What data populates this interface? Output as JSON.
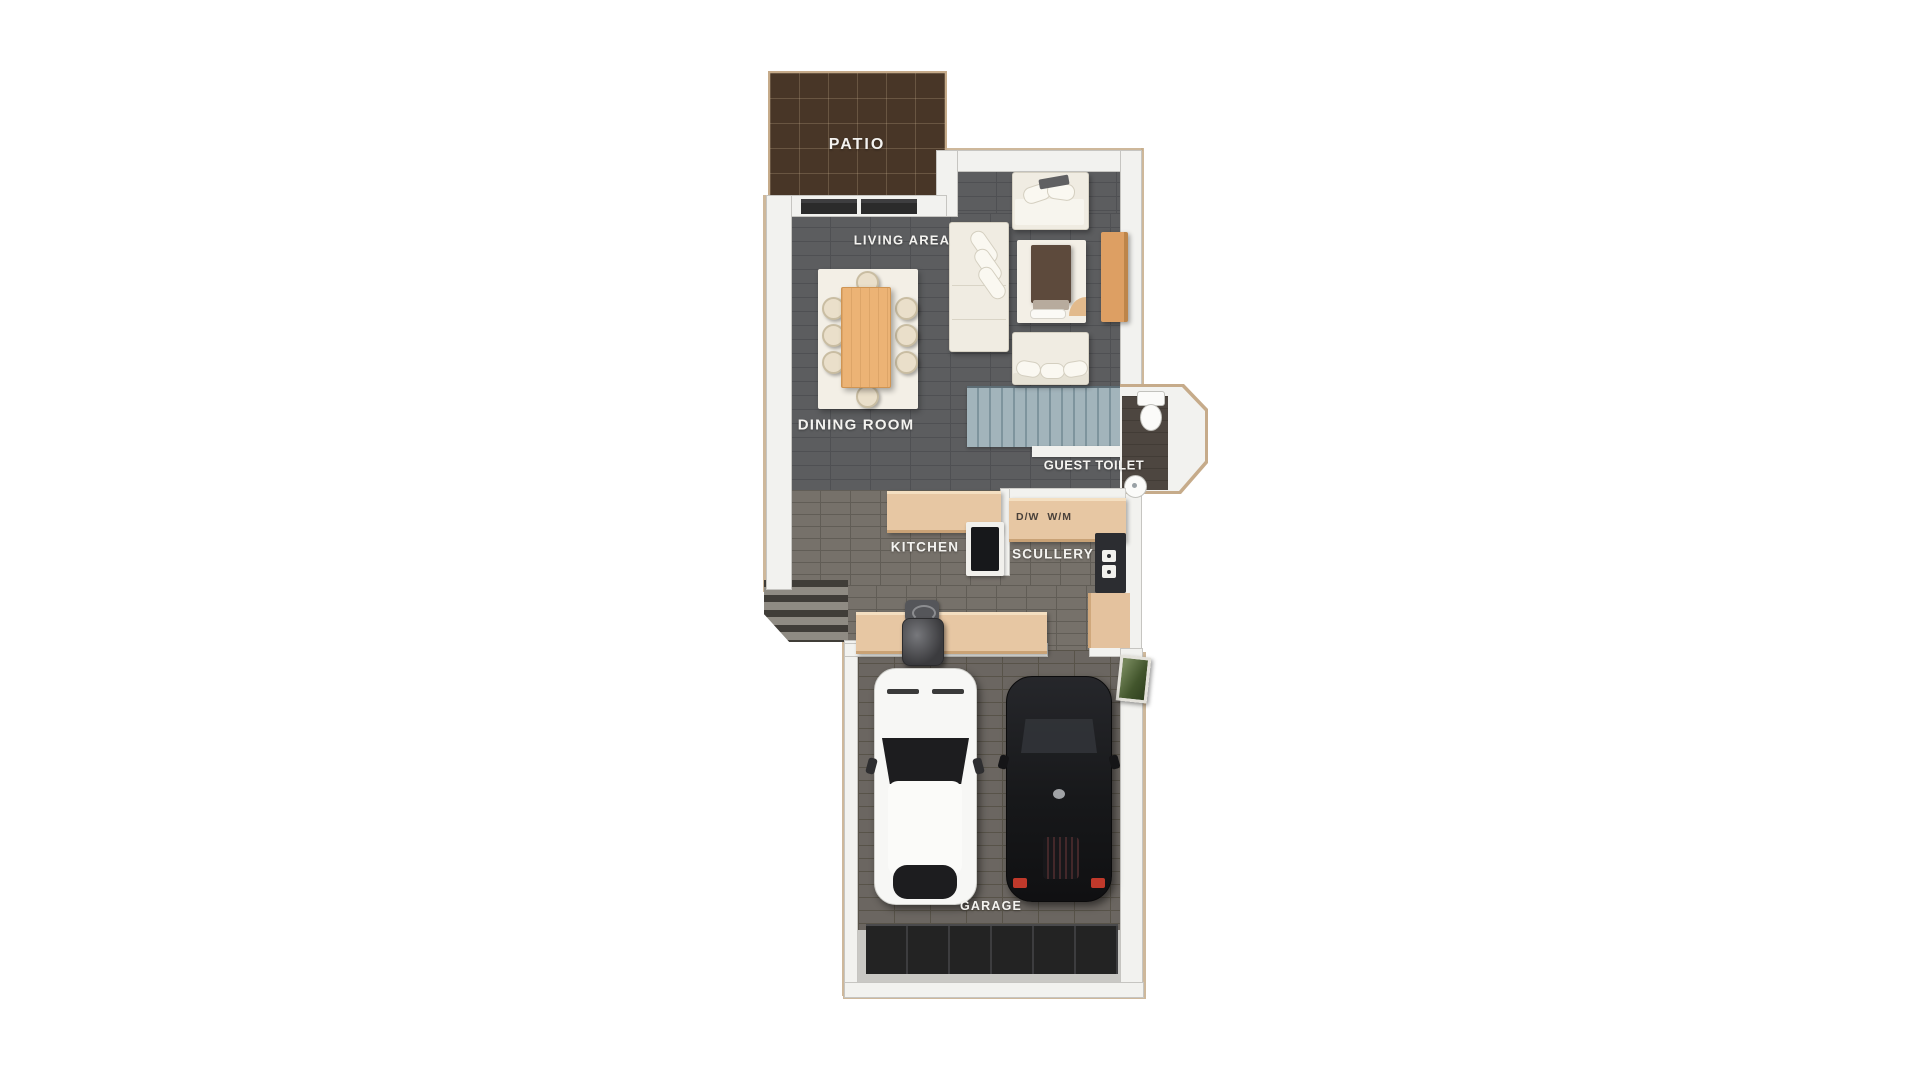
{
  "plan": {
    "type": "floor-plan",
    "labels": {
      "patio": "PATIO",
      "living_area": "LIVING AREA",
      "dining_room": "DINING ROOM",
      "guest_toilet": "GUEST TOILET",
      "kitchen": "KITCHEN",
      "scullery": "SCULLERY",
      "appliances": "D/W W/M",
      "garage": "GARAGE"
    },
    "colors": {
      "background": "#ffffff",
      "wall": "#f2f2ef",
      "outer_line": "#c6ab8a",
      "floor_dark": "#5c5d5f",
      "floor_kitchen": "#76716a",
      "floor_garage": "#6b6661",
      "floor_toilet": "#4d4640",
      "patio": "#483627",
      "stairs": "#a2b4bb",
      "counter": "#e7c7a3",
      "wood": "#ecb375",
      "sideboard": "#dd9f63",
      "sofa": "#f0ece2",
      "armchair_brown": "#5d4a3c",
      "car_white": "#f7f7f5",
      "car_black": "#1a1a1c",
      "garage_door": "#232323",
      "apron": "#c9c8c4",
      "green_board": "#55683b",
      "label_text": "#f4f3f0",
      "appliance_text": "#4a413a"
    },
    "furniture_icons": {
      "living": [
        "loveseat-sofa-icon",
        "three-seater-sofa-icon",
        "armchair-icon",
        "side-table-icon",
        "sideboard-icon"
      ],
      "dining": [
        "dining-table-icon",
        "dining-chair-icon"
      ],
      "toilet": [
        "toilet-icon",
        "washbasin-icon"
      ],
      "kitchen": [
        "cooktop-icon",
        "oven-tower-icon",
        "counter-icon"
      ],
      "garage": [
        "white-car-icon",
        "black-car-icon",
        "geyser-icon",
        "garage-door-icon",
        "notice-board-icon"
      ],
      "stairs": "staircase-icon",
      "door": "sliding-door-icon",
      "steps": "exterior-steps-icon"
    }
  }
}
